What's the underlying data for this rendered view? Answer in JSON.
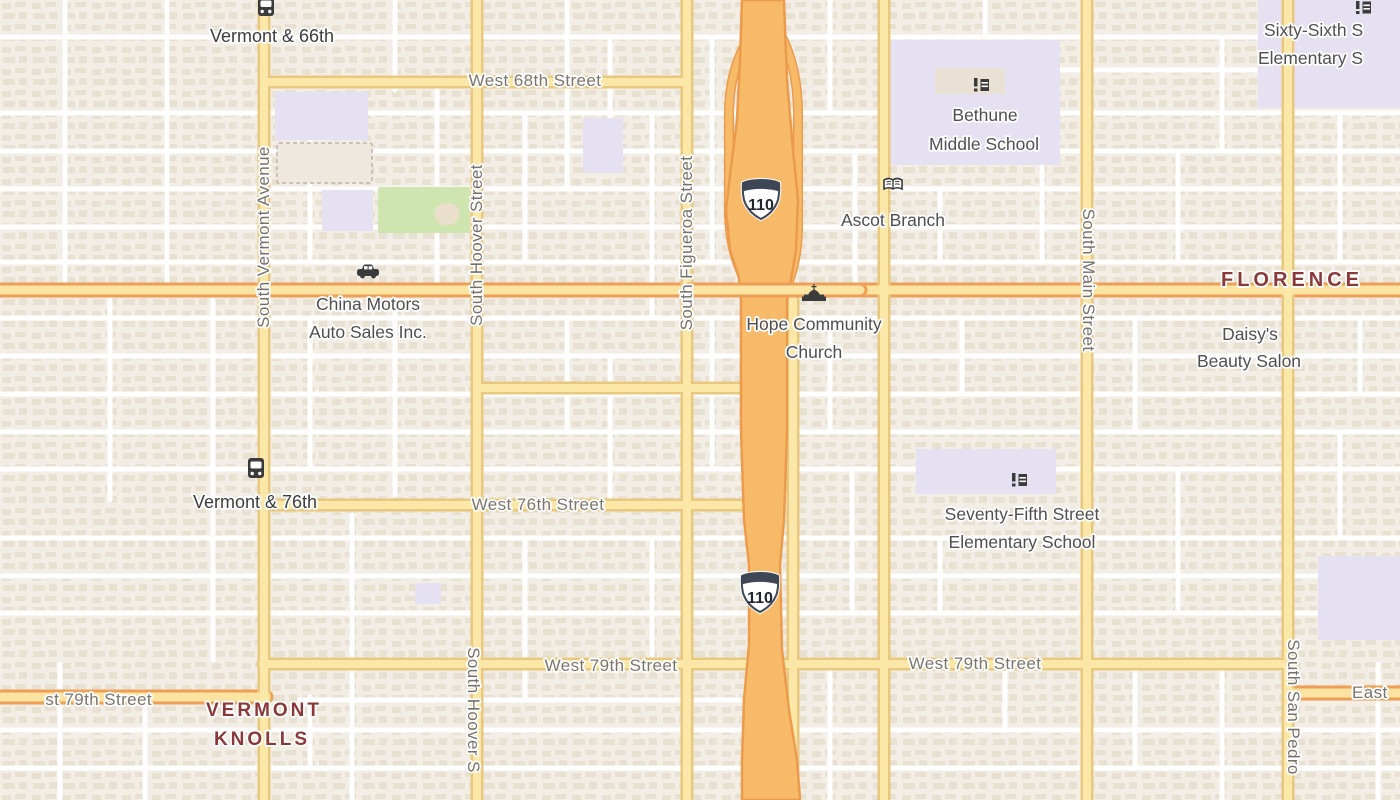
{
  "map_labels": {
    "transit_stops": {
      "vermont_66th": "Vermont & 66th",
      "vermont_76th": "Vermont & 76th"
    },
    "streets": {
      "west_68th": "West 68th Street",
      "west_76th": "West 76th Street",
      "west_79th": "West 79th Street",
      "west_79th_partial": "st 79th Street",
      "east_79th_partial": "East",
      "south_vermont": "South Vermont Avenue",
      "south_hoover": "South Hoover Street",
      "south_hoover_partial": "South Hoover S",
      "south_figueroa": "South Figueroa Street",
      "south_main": "South Main Street",
      "south_san_pedro": "South San Pedro"
    },
    "pois": {
      "china_motors": {
        "line1": "China Motors",
        "line2": "Auto Sales Inc."
      },
      "hope_community_church": {
        "line1": "Hope Community",
        "line2": "Church"
      },
      "bethune_middle_school": {
        "line1": "Bethune",
        "line2": "Middle School"
      },
      "ascot_branch": {
        "line1": "Ascot Branch"
      },
      "daisys_beauty_salon": {
        "line1": "Daisy's",
        "line2": "Beauty Salon"
      },
      "seventy_fifth_elementary": {
        "line1": "Seventy-Fifth Street",
        "line2": "Elementary School"
      },
      "sixty_sixth_elementary": {
        "line1": "Sixty-Sixth S",
        "line2": "Elementary S"
      }
    },
    "neighborhoods": {
      "florence": "FLORENCE",
      "vermont_knolls_line1": "VERMONT",
      "vermont_knolls_line2": "KNOLLS"
    },
    "highway_shield": "110"
  },
  "colors": {
    "freeway_fill": "#F7BA69",
    "freeway_casing": "#EC9B4D",
    "road_fill": "#FBE7A8",
    "road_casing": "#E9C87E",
    "arterial_casing": "#EE9F55",
    "minor_road": "#FFFFFF",
    "block_base": "#F3EEE5",
    "building": "#E4DBCB",
    "campus": "#E6E0F3",
    "park": "#CFE5AF",
    "neighborhood_text": "#8B3838",
    "street_text": "#7B766B",
    "poi_text": "#4F4F4F",
    "transit_text": "#3C3C3C",
    "shield_crown": "#3F4757"
  }
}
